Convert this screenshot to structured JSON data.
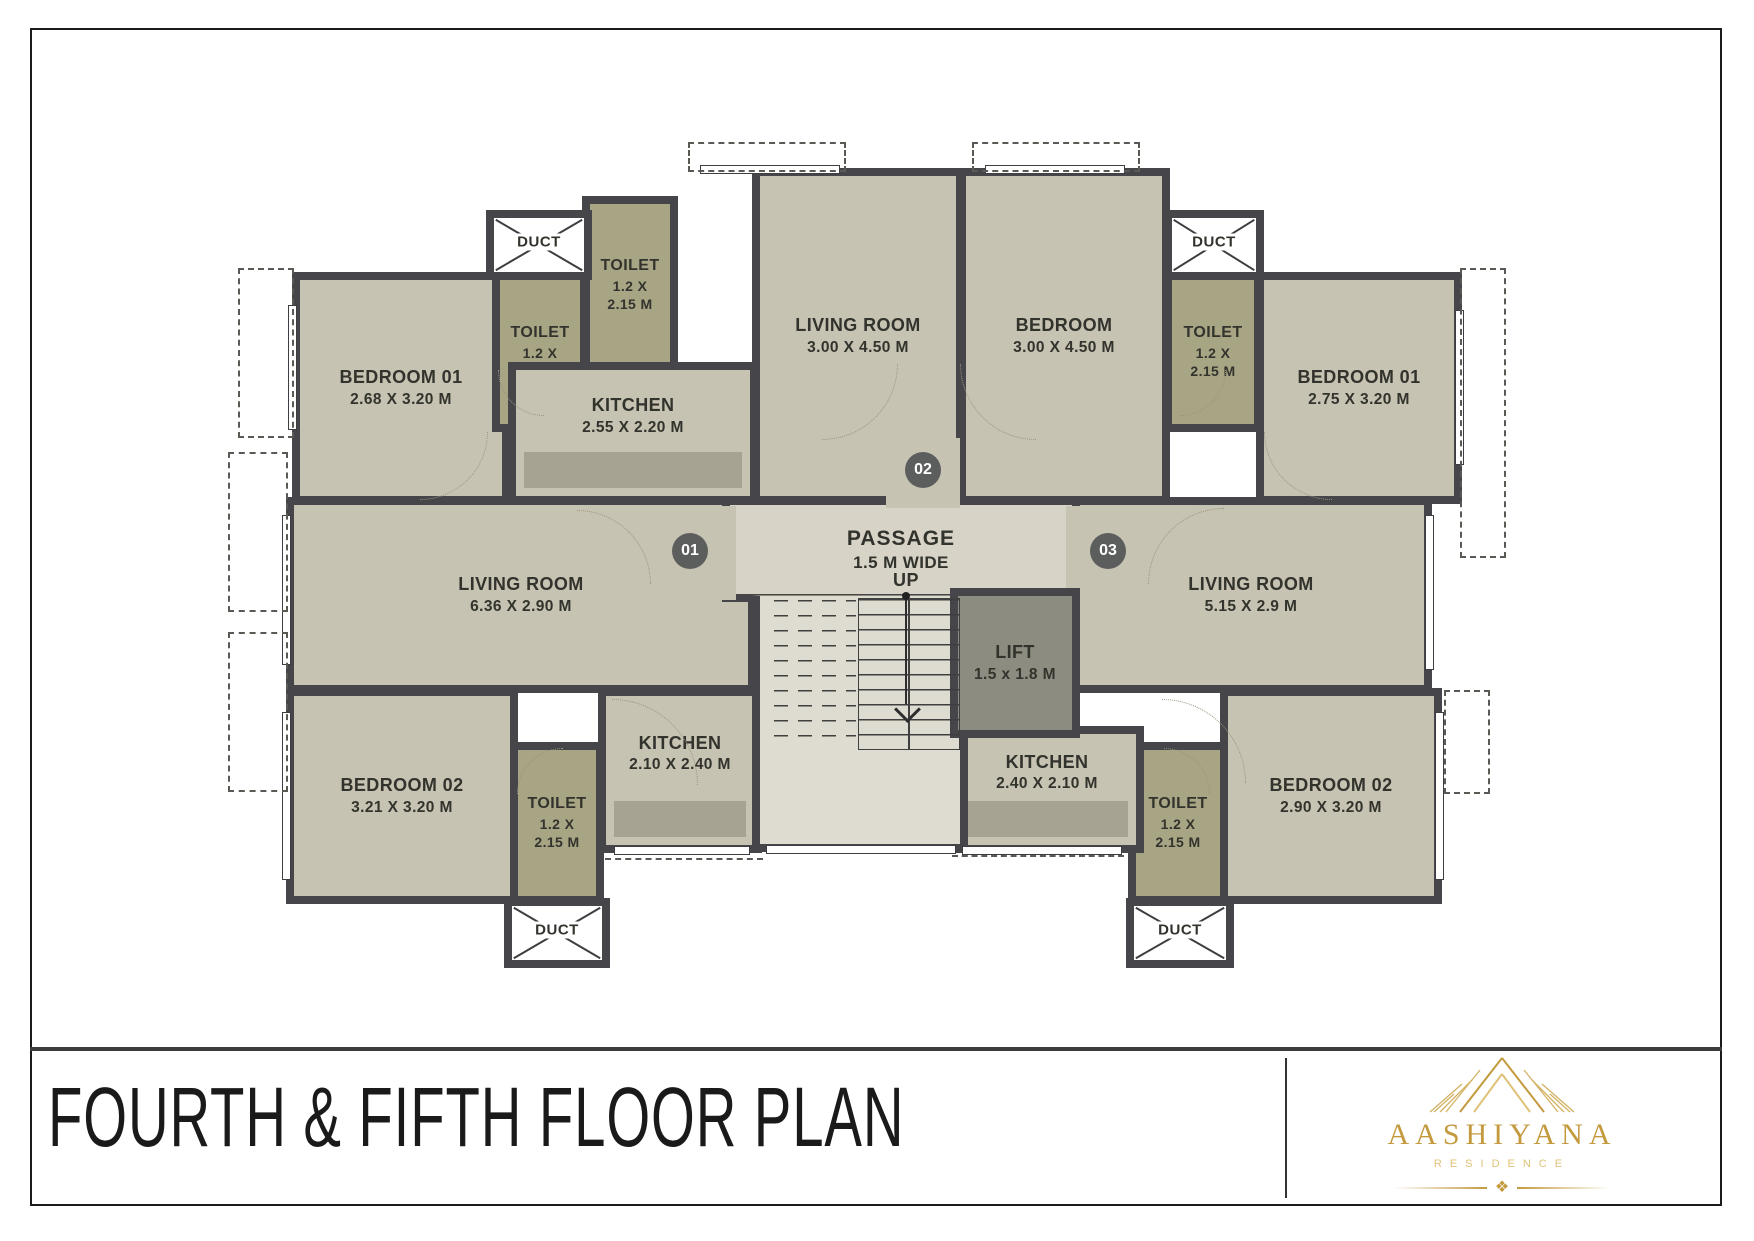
{
  "page": {
    "title": "FOURTH & FIFTH FLOOR PLAN",
    "brand": {
      "name": "AASHIYANA",
      "tagline": "RESIDENCE",
      "ornament_glyph": "❖"
    }
  },
  "colors": {
    "room": "#c7c3b2",
    "toilet": "#a8a585",
    "platform": "#a6a392",
    "passage": "#d7d3c7",
    "stairs": "#dedbd1",
    "lift": "#8c8d80",
    "wall": "#46464a",
    "text": "#33332d",
    "badge": "#5c5e5d",
    "gold": "#c49a3f",
    "title": "#1a1a1a"
  },
  "plan": {
    "duct_label": "DUCT",
    "rooms": [
      {
        "id": "bedroom-01-left",
        "name": "BEDROOM 01",
        "lines": [
          "2.68 X 3.20 M"
        ],
        "x": 292,
        "y": 272,
        "w": 218,
        "h": 232,
        "fill": "room"
      },
      {
        "id": "toilet-1",
        "name": "TOILET",
        "lines": [
          "1.2 X",
          "2.15 M"
        ],
        "x": 492,
        "y": 272,
        "w": 96,
        "h": 160,
        "fill": "toilet",
        "small": true
      },
      {
        "id": "toilet-2",
        "name": "TOILET",
        "lines": [
          "1.2 X",
          "2.15 M"
        ],
        "x": 582,
        "y": 196,
        "w": 96,
        "h": 178,
        "fill": "toilet",
        "small": true
      },
      {
        "id": "kitchen-1",
        "name": "KITCHEN",
        "lines": [
          "2.55 X 2.20 M"
        ],
        "x": 508,
        "y": 362,
        "w": 250,
        "h": 142,
        "fill": "room",
        "platform": true
      },
      {
        "id": "living-room-top",
        "name": "LIVING ROOM",
        "lines": [
          "3.00 X 4.50 M"
        ],
        "x": 752,
        "y": 168,
        "w": 212,
        "h": 336,
        "fill": "room"
      },
      {
        "id": "bedroom-top",
        "name": "BEDROOM",
        "lines": [
          "3.00 X 4.50 M"
        ],
        "x": 958,
        "y": 168,
        "w": 212,
        "h": 336,
        "fill": "room"
      },
      {
        "id": "toilet-3",
        "name": "TOILET",
        "lines": [
          "1.2 X",
          "2.15 M"
        ],
        "x": 1164,
        "y": 272,
        "w": 98,
        "h": 160,
        "fill": "toilet",
        "small": true
      },
      {
        "id": "bedroom-01-right",
        "name": "BEDROOM 01",
        "lines": [
          "2.75 X 3.20 M"
        ],
        "x": 1256,
        "y": 272,
        "w": 206,
        "h": 232,
        "fill": "room"
      },
      {
        "id": "living-room-left",
        "name": "LIVING ROOM",
        "lines": [
          "6.36 X 2.90 M"
        ],
        "x": 286,
        "y": 497,
        "w": 470,
        "h": 196,
        "fill": "room"
      },
      {
        "id": "living-room-right",
        "name": "LIVING ROOM",
        "lines": [
          "5.15 X 2.9 M"
        ],
        "x": 1070,
        "y": 497,
        "w": 362,
        "h": 196,
        "fill": "room"
      },
      {
        "id": "bedroom-02-left",
        "name": "BEDROOM 02",
        "lines": [
          "3.21 X 3.20 M"
        ],
        "x": 286,
        "y": 688,
        "w": 232,
        "h": 216,
        "fill": "room"
      },
      {
        "id": "toilet-4",
        "name": "TOILET",
        "lines": [
          "1.2 X",
          "2.15 M"
        ],
        "x": 510,
        "y": 742,
        "w": 94,
        "h": 162,
        "fill": "toilet",
        "small": true
      },
      {
        "id": "kitchen-2",
        "name": "KITCHEN",
        "lines": [
          "2.10 X 2.40 M"
        ],
        "x": 598,
        "y": 688,
        "w": 164,
        "h": 165,
        "fill": "room",
        "platform": true
      },
      {
        "id": "bedroom-02-right",
        "name": "BEDROOM 02",
        "lines": [
          "2.90 X 3.20 M"
        ],
        "x": 1220,
        "y": 688,
        "w": 222,
        "h": 216,
        "fill": "room"
      },
      {
        "id": "toilet-5",
        "name": "TOILET",
        "lines": [
          "1.2 X",
          "2.15 M"
        ],
        "x": 1128,
        "y": 742,
        "w": 100,
        "h": 162,
        "fill": "toilet",
        "small": true
      },
      {
        "id": "kitchen-3",
        "name": "KITCHEN",
        "lines": [
          "2.40 X 2.10 M"
        ],
        "x": 950,
        "y": 726,
        "w": 194,
        "h": 127,
        "fill": "room",
        "platform": true
      },
      {
        "id": "passage",
        "name": "PASSAGE",
        "lines": [
          "1.5 M WIDE"
        ],
        "x": 722,
        "y": 497,
        "w": 358,
        "h": 105,
        "fill": "passage",
        "big": true
      },
      {
        "id": "entry-alcove-01",
        "name": "",
        "lines": [],
        "x": 650,
        "y": 506,
        "w": 86,
        "h": 94,
        "fill": "room",
        "open": true
      },
      {
        "id": "entry-alcove-03",
        "name": "",
        "lines": [],
        "x": 1066,
        "y": 506,
        "w": 86,
        "h": 94,
        "fill": "room",
        "open": true
      },
      {
        "id": "entry-recess-02",
        "name": "",
        "lines": [],
        "x": 886,
        "y": 438,
        "w": 74,
        "h": 70,
        "fill": "room",
        "open": true
      },
      {
        "id": "stairwell",
        "name": "",
        "lines": [],
        "x": 752,
        "y": 595,
        "w": 216,
        "h": 257,
        "fill": "stairs"
      },
      {
        "id": "lift",
        "name": "LIFT",
        "lines": [
          "1.5 x 1.8 M"
        ],
        "x": 950,
        "y": 588,
        "w": 130,
        "h": 150,
        "fill": "lift"
      }
    ],
    "ducts": [
      {
        "label": "DUCT",
        "x": 486,
        "y": 210,
        "w": 106,
        "h": 70
      },
      {
        "label": "DUCT",
        "x": 1164,
        "y": 210,
        "w": 100,
        "h": 70
      },
      {
        "label": "DUCT",
        "x": 504,
        "y": 898,
        "w": 106,
        "h": 70
      },
      {
        "label": "DUCT",
        "x": 1126,
        "y": 898,
        "w": 108,
        "h": 70
      }
    ],
    "badges": [
      {
        "label": "01",
        "x": 690,
        "y": 551
      },
      {
        "label": "02",
        "x": 923,
        "y": 470
      },
      {
        "label": "03",
        "x": 1108,
        "y": 551
      }
    ],
    "stairs": {
      "up_label": "UP",
      "dashed": {
        "x": 764,
        "y": 600,
        "w": 92,
        "h": 150
      },
      "solid": {
        "x": 858,
        "y": 598,
        "w": 102,
        "h": 152
      },
      "center_line": {
        "x": 908,
        "y": 598,
        "h": 152
      },
      "up_xy": {
        "x": 906,
        "y": 570
      },
      "dot_xy": {
        "x": 902,
        "y": 592
      },
      "arrow_line": {
        "x": 905,
        "y": 600,
        "h": 104
      },
      "chevron_xy": {
        "x": 898,
        "y": 700
      }
    },
    "windows": [
      {
        "x": 288,
        "y": 305,
        "w": 9,
        "h": 125
      },
      {
        "x": 282,
        "y": 515,
        "w": 9,
        "h": 150
      },
      {
        "x": 282,
        "y": 712,
        "w": 9,
        "h": 168
      },
      {
        "x": 1455,
        "y": 310,
        "w": 9,
        "h": 155
      },
      {
        "x": 1425,
        "y": 515,
        "w": 9,
        "h": 155
      },
      {
        "x": 1435,
        "y": 712,
        "w": 9,
        "h": 168
      },
      {
        "x": 700,
        "y": 165,
        "w": 140,
        "h": 9
      },
      {
        "x": 985,
        "y": 165,
        "w": 140,
        "h": 9
      },
      {
        "x": 614,
        "y": 846,
        "w": 136,
        "h": 9
      },
      {
        "x": 962,
        "y": 846,
        "w": 160,
        "h": 9
      },
      {
        "x": 766,
        "y": 845,
        "w": 190,
        "h": 9
      }
    ],
    "balconies": [
      {
        "x": 688,
        "y": 142,
        "w": 158,
        "h": 30
      },
      {
        "x": 972,
        "y": 142,
        "w": 168,
        "h": 30
      },
      {
        "x": 238,
        "y": 268,
        "w": 56,
        "h": 170
      },
      {
        "x": 228,
        "y": 452,
        "w": 60,
        "h": 160
      },
      {
        "x": 228,
        "y": 632,
        "w": 60,
        "h": 160
      },
      {
        "x": 1460,
        "y": 268,
        "w": 46,
        "h": 290
      },
      {
        "x": 1444,
        "y": 690,
        "w": 46,
        "h": 104
      }
    ],
    "dashlines": [
      {
        "x": 605,
        "y": 858,
        "w": 158
      },
      {
        "x": 952,
        "y": 855,
        "w": 172
      }
    ],
    "arcs": [
      {
        "x": 822,
        "y": 364,
        "s": 76,
        "c": "br"
      },
      {
        "x": 960,
        "y": 364,
        "s": 76,
        "c": "bl"
      },
      {
        "x": 577,
        "y": 510,
        "s": 74,
        "c": "tr"
      },
      {
        "x": 1148,
        "y": 508,
        "s": 76,
        "c": "tl"
      },
      {
        "x": 612,
        "y": 699,
        "s": 86,
        "c": "tr"
      },
      {
        "x": 1162,
        "y": 699,
        "s": 84,
        "c": "tr"
      },
      {
        "x": 420,
        "y": 432,
        "s": 68,
        "c": "br"
      },
      {
        "x": 1264,
        "y": 432,
        "s": 68,
        "c": "bl"
      },
      {
        "x": 498,
        "y": 370,
        "s": 46,
        "c": "bl"
      },
      {
        "x": 1180,
        "y": 370,
        "s": 46,
        "c": "br"
      },
      {
        "x": 517,
        "y": 748,
        "s": 46,
        "c": "tl"
      },
      {
        "x": 1164,
        "y": 748,
        "s": 46,
        "c": "tr"
      }
    ]
  }
}
